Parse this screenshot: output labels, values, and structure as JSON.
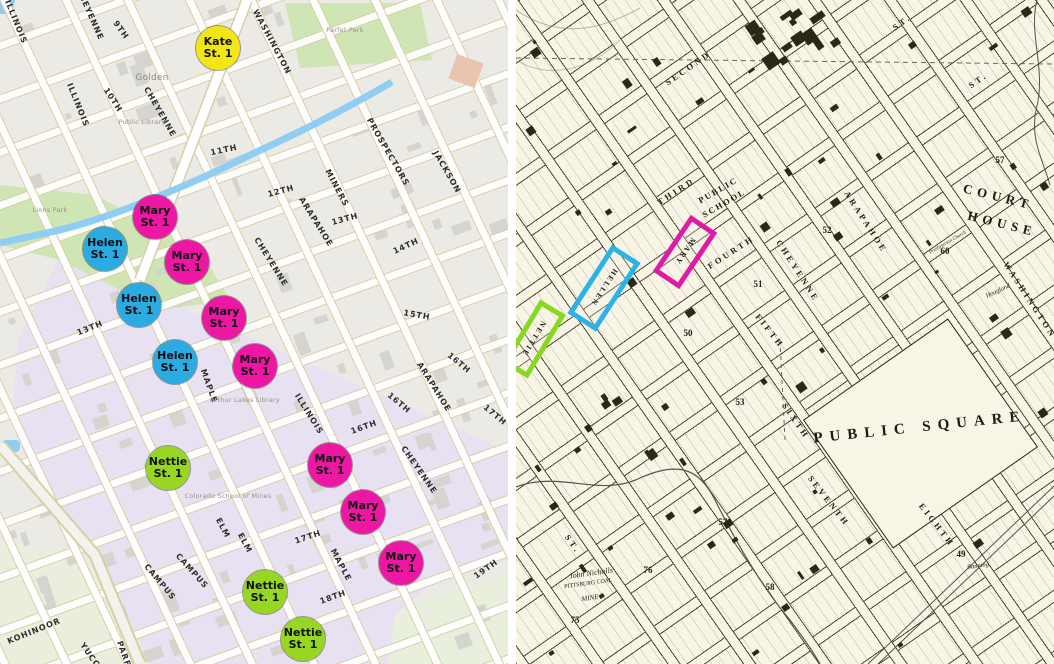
{
  "left_map": {
    "marker_suffix": "St. 1",
    "markers": [
      {
        "name": "Kate",
        "line2": "St. 1",
        "x": 218,
        "y": 48,
        "color": "#f2e615"
      },
      {
        "name": "Mary",
        "line2": "St. 1",
        "x": 155,
        "y": 217,
        "color": "#ee17a4"
      },
      {
        "name": "Helen",
        "line2": "St. 1",
        "x": 105,
        "y": 249,
        "color": "#2aace2"
      },
      {
        "name": "Mary",
        "line2": "St. 1",
        "x": 187,
        "y": 262,
        "color": "#ee17a4"
      },
      {
        "name": "Helen",
        "line2": "St. 1",
        "x": 139,
        "y": 305,
        "color": "#2aace2"
      },
      {
        "name": "Mary",
        "line2": "St. 1",
        "x": 224,
        "y": 318,
        "color": "#ee17a4"
      },
      {
        "name": "Helen",
        "line2": "St. 1",
        "x": 175,
        "y": 362,
        "color": "#2aace2"
      },
      {
        "name": "Mary",
        "line2": "St. 1",
        "x": 255,
        "y": 366,
        "color": "#ee17a4"
      },
      {
        "name": "Nettie",
        "line2": "St. 1",
        "x": 168,
        "y": 468,
        "color": "#97d723"
      },
      {
        "name": "Mary",
        "line2": "St. 1",
        "x": 330,
        "y": 465,
        "color": "#ee17a4"
      },
      {
        "name": "Mary",
        "line2": "St. 1",
        "x": 363,
        "y": 512,
        "color": "#ee17a4"
      },
      {
        "name": "Mary",
        "line2": "St. 1",
        "x": 401,
        "y": 563,
        "color": "#ee17a4"
      },
      {
        "name": "Nettie",
        "line2": "St. 1",
        "x": 265,
        "y": 592,
        "color": "#97d723"
      },
      {
        "name": "Nettie",
        "line2": "St. 1",
        "x": 303,
        "y": 639,
        "color": "#97d723"
      }
    ],
    "street_labels": [
      {
        "t": "ILLINOIS",
        "x": 16,
        "y": 22,
        "r": 68
      },
      {
        "t": "CHEYENNE",
        "x": 90,
        "y": 14,
        "r": 66
      },
      {
        "t": "9TH",
        "x": 121,
        "y": 30,
        "r": 55
      },
      {
        "t": "WASHINGTON",
        "x": 272,
        "y": 42,
        "r": 62
      },
      {
        "t": "ILLINOIS",
        "x": 78,
        "y": 105,
        "r": 68
      },
      {
        "t": "10TH",
        "x": 113,
        "y": 100,
        "r": 57
      },
      {
        "t": "CHEYENNE",
        "x": 160,
        "y": 112,
        "r": 60
      },
      {
        "t": "11TH",
        "x": 224,
        "y": 150,
        "r": -12
      },
      {
        "t": "12TH",
        "x": 281,
        "y": 191,
        "r": -15
      },
      {
        "t": "MINERS",
        "x": 337,
        "y": 188,
        "r": 62
      },
      {
        "t": "PROSPECTORS",
        "x": 388,
        "y": 152,
        "r": 60
      },
      {
        "t": "JACKSON",
        "x": 447,
        "y": 172,
        "r": 60
      },
      {
        "t": "13TH",
        "x": 345,
        "y": 219,
        "r": -15
      },
      {
        "t": "14TH",
        "x": 406,
        "y": 246,
        "r": -25
      },
      {
        "t": "ARAPAHOE",
        "x": 316,
        "y": 222,
        "r": 58
      },
      {
        "t": "CHEYENNE",
        "x": 271,
        "y": 262,
        "r": 58
      },
      {
        "t": "13TH",
        "x": 90,
        "y": 328,
        "r": -22
      },
      {
        "t": "15TH",
        "x": 417,
        "y": 315,
        "r": 10
      },
      {
        "t": "16TH",
        "x": 459,
        "y": 363,
        "r": 40
      },
      {
        "t": "ARAPAHOE",
        "x": 434,
        "y": 387,
        "r": 58
      },
      {
        "t": "16TH",
        "x": 399,
        "y": 403,
        "r": 40
      },
      {
        "t": "17TH",
        "x": 495,
        "y": 415,
        "r": 40
      },
      {
        "t": "CHEYENNE",
        "x": 419,
        "y": 470,
        "r": 55
      },
      {
        "t": "MAPLE",
        "x": 209,
        "y": 386,
        "r": 70
      },
      {
        "t": "ILLINOIS",
        "x": 309,
        "y": 414,
        "r": 58
      },
      {
        "t": "16TH",
        "x": 364,
        "y": 427,
        "r": -20
      },
      {
        "t": "ELM",
        "x": 223,
        "y": 528,
        "r": 62
      },
      {
        "t": "ELM",
        "x": 245,
        "y": 543,
        "r": 62
      },
      {
        "t": "17TH",
        "x": 308,
        "y": 537,
        "r": -18
      },
      {
        "t": "MAPLE",
        "x": 341,
        "y": 565,
        "r": 62
      },
      {
        "t": "18TH",
        "x": 333,
        "y": 597,
        "r": -20
      },
      {
        "t": "19TH",
        "x": 486,
        "y": 569,
        "r": -35
      },
      {
        "t": "CAMPUS",
        "x": 160,
        "y": 582,
        "r": 50
      },
      {
        "t": "CAMPUS",
        "x": 192,
        "y": 571,
        "r": 48
      },
      {
        "t": "KOHINOOR",
        "x": 34,
        "y": 631,
        "r": -22
      },
      {
        "t": "YUCCA",
        "x": 92,
        "y": 658,
        "r": 55
      },
      {
        "t": "PARFET",
        "x": 126,
        "y": 660,
        "r": 70
      }
    ],
    "poi_labels": [
      {
        "t": "Golden",
        "x": 152,
        "y": 78,
        "big": true
      },
      {
        "t": "Parfet Park",
        "x": 345,
        "y": 30,
        "big": false
      },
      {
        "t": "Lions Park",
        "x": 50,
        "y": 210,
        "big": false
      },
      {
        "t": "Public Library",
        "x": 142,
        "y": 122,
        "big": false
      },
      {
        "t": "Arthur Lakes Library",
        "x": 245,
        "y": 400,
        "big": false
      },
      {
        "t": "Colorado School of Mines",
        "x": 228,
        "y": 496,
        "big": false
      }
    ],
    "colors": {
      "campus_overlay": "#e8e1f1",
      "park_green": "#cfe5b4",
      "hill_green": "#e9eedd",
      "water_blue": "#8fcdf2",
      "building_gray": "#d6d4cf"
    }
  },
  "right_map": {
    "big_labels": {
      "public_square": "PUBLIC SQUARE",
      "court_house_line1": "COURT",
      "court_house_line2": "HOUSE",
      "public_school_line1": "PUBLIC",
      "public_school_line2": "SCHOOL"
    },
    "street_labels": [
      {
        "t": "SECOND",
        "x": 172,
        "y": 68,
        "r": -35
      },
      {
        "t": "ST.",
        "x": 386,
        "y": 22,
        "r": -35
      },
      {
        "t": "ST.",
        "x": 462,
        "y": 80,
        "r": -35
      },
      {
        "t": "THIRD",
        "x": 160,
        "y": 191,
        "r": -33
      },
      {
        "t": "FOURTH",
        "x": 215,
        "y": 252,
        "r": -33
      },
      {
        "t": "FIFTH",
        "x": 254,
        "y": 331,
        "r": 52
      },
      {
        "t": "SIXTH",
        "x": 280,
        "y": 421,
        "r": 55
      },
      {
        "t": "SEVENTH",
        "x": 313,
        "y": 501,
        "r": 52
      },
      {
        "t": "EIGHTH",
        "x": 421,
        "y": 525,
        "r": 52
      },
      {
        "t": "CHEYENNE",
        "x": 282,
        "y": 271,
        "r": 57
      },
      {
        "t": "ARAPAHOE",
        "x": 350,
        "y": 222,
        "r": 57
      },
      {
        "t": "WASHINGTON",
        "x": 514,
        "y": 300,
        "r": 57
      },
      {
        "t": "ST.",
        "x": 57,
        "y": 544,
        "r": 55
      }
    ],
    "block_numbers": [
      {
        "t": "50",
        "x": 172,
        "y": 333
      },
      {
        "t": "51",
        "x": 242,
        "y": 284
      },
      {
        "t": "52",
        "x": 311,
        "y": 230
      },
      {
        "t": "53",
        "x": 224,
        "y": 402
      },
      {
        "t": "57",
        "x": 484,
        "y": 160
      },
      {
        "t": "57",
        "x": 207,
        "y": 522
      },
      {
        "t": "60",
        "x": 429,
        "y": 251
      },
      {
        "t": "58",
        "x": 254,
        "y": 587
      },
      {
        "t": "76",
        "x": 132,
        "y": 570
      },
      {
        "t": "75",
        "x": 59,
        "y": 620
      },
      {
        "t": "49",
        "x": 445,
        "y": 554
      }
    ],
    "annotations": [
      {
        "t": "John Nicholls",
        "x": 75,
        "y": 573,
        "r": -8,
        "s": 8
      },
      {
        "t": "PITTSBURG COAL",
        "x": 72,
        "y": 584,
        "r": -8,
        "s": 6
      },
      {
        "t": "MINE",
        "x": 74,
        "y": 598,
        "r": -8,
        "s": 7
      },
      {
        "t": "Hoagland",
        "x": 482,
        "y": 291,
        "r": -25,
        "s": 6.5
      },
      {
        "t": "Banning",
        "x": 462,
        "y": 566,
        "r": -8,
        "s": 6.5
      },
      {
        "t": "Presbyterian Church",
        "x": 432,
        "y": 243,
        "r": -30,
        "s": 5
      }
    ],
    "highlight_rects": [
      {
        "label": "MARY",
        "x": 169,
        "y": 252,
        "w": 22,
        "h": 58,
        "rot": 34,
        "color": "#df1ba5"
      },
      {
        "label": "HELLEN",
        "x": 88,
        "y": 288,
        "w": 24,
        "h": 72,
        "rot": 33,
        "color": "#2bb3e8"
      },
      {
        "label": "NETTIE",
        "x": 18,
        "y": 339,
        "w": 20,
        "h": 64,
        "rot": 31,
        "color": "#86d91e"
      }
    ],
    "colors": {
      "paper_cream": "#f8f4e6",
      "ink_black": "#2b2719"
    }
  }
}
